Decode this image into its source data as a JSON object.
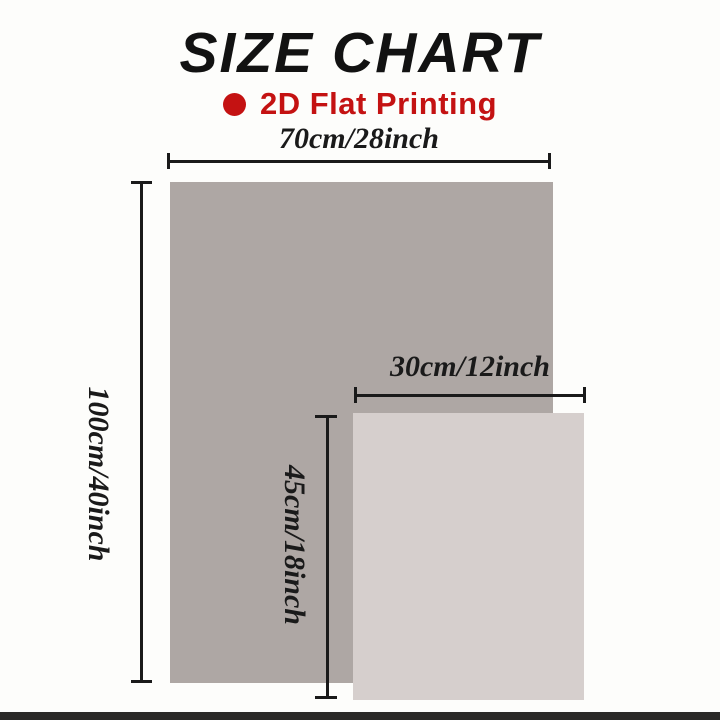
{
  "title": "SIZE CHART",
  "subtitle": {
    "bullet_icon": "red-dot",
    "label": "2D Flat Printing",
    "color": "#c41212"
  },
  "dimensions": {
    "large": {
      "width_label": "70cm/28inch",
      "height_label": "100cm/40inch"
    },
    "small": {
      "width_label": "30cm/12inch",
      "height_label": "45cm/18inch"
    }
  },
  "colors": {
    "background": "#fdfdfb",
    "title_text": "#121212",
    "accent_red": "#c41212",
    "large_rect_fill": "#aea7a4",
    "small_rect_fill": "#d6cfcd",
    "dimension_line": "#1a1a1a",
    "bottom_bar": "#2a2927"
  }
}
